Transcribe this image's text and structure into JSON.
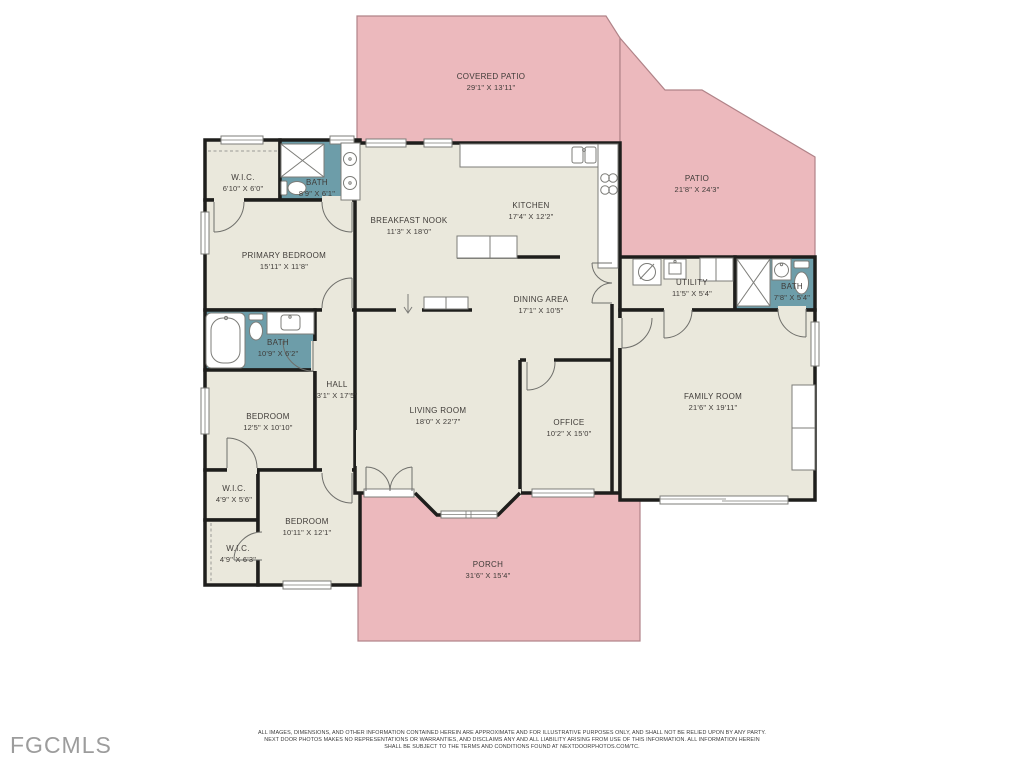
{
  "branding": {
    "logo": "FGCMLS"
  },
  "colors": {
    "patio": "#ecb9bd",
    "patioStroke": "#b08388",
    "floor": "#eae8dc",
    "bath": "#6d9da9",
    "wall": "#1e1e1c",
    "label": "#3f3b38",
    "logo": "#9c9c9c"
  },
  "rooms": [
    {
      "name": "COVERED PATIO",
      "dims": "29'1\" X 13'11\""
    },
    {
      "name": "PATIO",
      "dims": "21'8\" X 24'3\""
    },
    {
      "name": "W.I.C.",
      "dims": "6'10\" X 6'0\""
    },
    {
      "name": "BATH",
      "dims": "8'9\" X 6'1\""
    },
    {
      "name": "PRIMARY BEDROOM",
      "dims": "15'11\" X 11'8\""
    },
    {
      "name": "BREAKFAST NOOK",
      "dims": "11'3\" X 18'0\""
    },
    {
      "name": "KITCHEN",
      "dims": "17'4\" X 12'2\""
    },
    {
      "name": "DINING AREA",
      "dims": "17'1\" X 10'5\""
    },
    {
      "name": "UTILITY",
      "dims": "11'5\" X 5'4\""
    },
    {
      "name": "BATH",
      "dims": "7'8\" X 5'4\""
    },
    {
      "name": "BATH",
      "dims": "10'9\" X 6'2\""
    },
    {
      "name": "HALL",
      "dims": "3'1\" X 17'5\""
    },
    {
      "name": "BEDROOM",
      "dims": "12'5\" X 10'10\""
    },
    {
      "name": "LIVING ROOM",
      "dims": "18'0\" X 22'7\""
    },
    {
      "name": "OFFICE",
      "dims": "10'2\" X 15'0\""
    },
    {
      "name": "FAMILY ROOM",
      "dims": "21'6\" X 19'11\""
    },
    {
      "name": "W.I.C.",
      "dims": "4'9\" X 5'6\""
    },
    {
      "name": "W.I.C.",
      "dims": "4'9\" X 6'3\""
    },
    {
      "name": "BEDROOM",
      "dims": "10'11\" X 12'1\""
    },
    {
      "name": "PORCH",
      "dims": "31'6\" X 15'4\""
    }
  ],
  "disclaimer": {
    "line1": "ALL IMAGES, DIMENSIONS, AND OTHER INFORMATION CONTAINED HEREIN ARE APPROXIMATE AND FOR ILLUSTRATIVE PURPOSES ONLY, AND SHALL NOT BE RELIED UPON BY ANY PARTY.",
    "line2": "NEXT DOOR PHOTOS MAKES NO REPRESENTATIONS OR WARRANTIES, AND DISCLAIMS ANY AND ALL LIABILITY ARISING FROM USE OF THIS INFORMATION. ALL INFORMATION HEREIN",
    "line3": "SHALL BE SUBJECT TO THE TERMS AND CONDITIONS FOUND AT NEXTDOORPHOTOS.COM/TC."
  }
}
